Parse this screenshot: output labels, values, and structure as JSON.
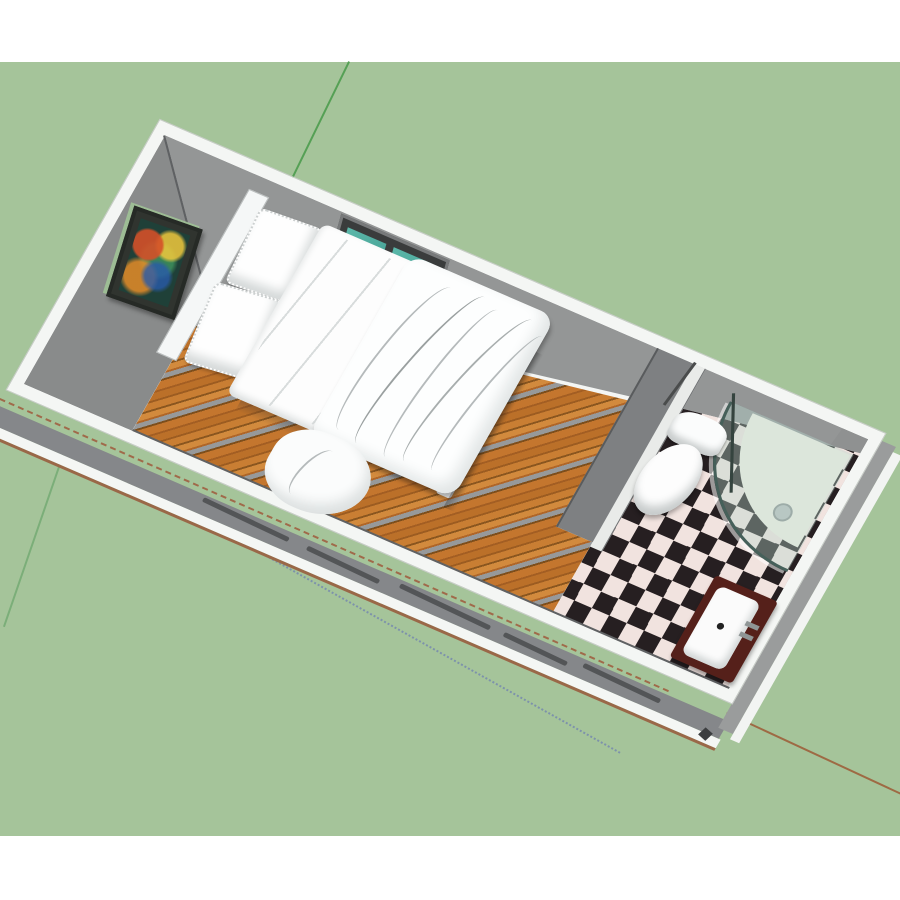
{
  "scene": {
    "kind": "3d-architectural-model-render",
    "style": "sketchup-like isometric top view",
    "description": "Long rectangular container-home unit rotated diagonally on a green ground, containing a bedroom with double bed and a bathroom with checkered tile floor",
    "rooms": [
      {
        "label": "bedroom",
        "floor": "wood planks"
      },
      {
        "label": "bathroom",
        "floor": "black and white checker tile"
      }
    ],
    "objects": [
      {
        "label": "double bed with white duvet and two pillows"
      },
      {
        "label": "headboard"
      },
      {
        "label": "framed abstract art on wall"
      },
      {
        "label": "window with two teal glass panes and white sill"
      },
      {
        "label": "partition wall with doorway"
      },
      {
        "label": "toilet with tank"
      },
      {
        "label": "corner shower with curved glass and tray drain"
      },
      {
        "label": "sink vanity with dark counter, white basin and faucet"
      }
    ],
    "axes": [
      {
        "label": "green axis",
        "style": "solid"
      },
      {
        "label": "red axis positive",
        "style": "solid"
      },
      {
        "label": "red axis negative",
        "style": "dashed"
      },
      {
        "label": "blue axis negative",
        "style": "dotted"
      }
    ]
  },
  "palette": {
    "canvas_white": "#ffffff",
    "background_green": "#a5c49a",
    "wall_top_white": "#f4f6f4",
    "wall_interior_gray_ne": "#949696",
    "wall_interior_gray_nw": "#898b8b",
    "wall_exterior_gray": "#85878a",
    "wood_floor_primary": "#bb7029",
    "tile_black": "#261f21",
    "tile_white": "#f1e3df",
    "window_glass_teal": "#4aa79c",
    "shower_glass_tint": "#b9d7cd",
    "vanity_counter_maroon": "#55201a",
    "axis_green": "#55a055",
    "axis_red": "#9e6a44",
    "axis_blue": "#7d92ab"
  },
  "layout_note": "no visible text in screenshot"
}
